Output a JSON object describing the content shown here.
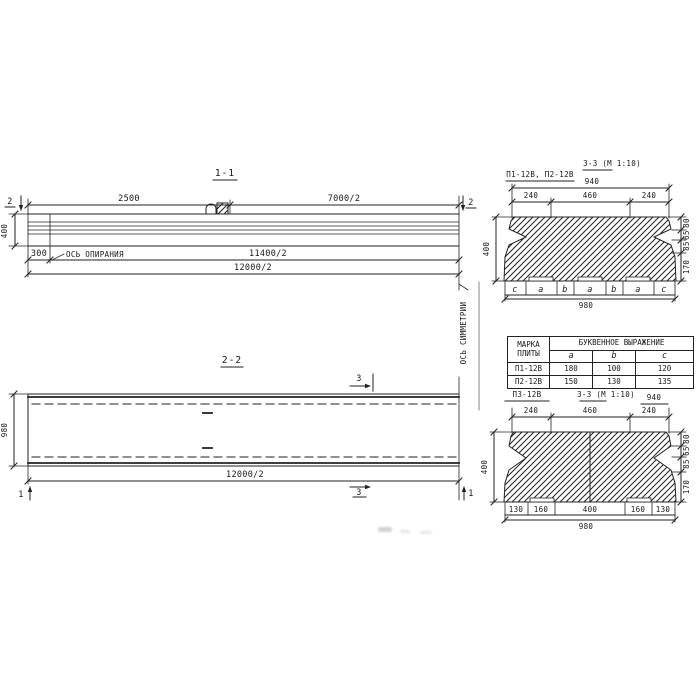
{
  "s11": {
    "title": "1-1",
    "d2500": "2500",
    "d7000": "7000/2",
    "m2": "2",
    "d400": "400",
    "d300": "300",
    "axis": "ОСЬ ОПИРАНИЯ",
    "d11400": "11400/2",
    "d12000": "12000/2"
  },
  "sym": {
    "label": "ОСЬ СИММЕТРИИ"
  },
  "s22": {
    "title": "2-2",
    "m3": "3",
    "m1": "1",
    "d980": "980",
    "d12000": "12000/2"
  },
  "p12": {
    "label": "П1-12В, П2-12В",
    "title": "3-3 (М 1:10)",
    "d940": "940",
    "d240": "240",
    "d460": "460",
    "d400": "400",
    "r0": "80",
    "r1": "65",
    "r2": "85",
    "r3": "170",
    "L0": "c",
    "L1": "a",
    "L2": "b",
    "d980": "980"
  },
  "table": {
    "header_mark": "МАРКА ПЛИТЫ",
    "header_expr": "БУКВЕННОЕ ВЫРАЖЕНИЕ",
    "cols": [
      "a",
      "b",
      "c"
    ],
    "rows": [
      {
        "mark": "П1-12В",
        "a": "180",
        "b": "100",
        "c": "120"
      },
      {
        "mark": "П2-12В",
        "a": "150",
        "b": "130",
        "c": "135"
      }
    ]
  },
  "p3": {
    "label": "П3-12В",
    "title": "3-3 (М 1:10)",
    "d940": "940",
    "d240": "240",
    "d460": "460",
    "d400": "400",
    "r0": "80",
    "r1": "65",
    "r2": "85",
    "r3": "170",
    "b130": "130",
    "b160": "160",
    "b400": "400",
    "d980": "980"
  }
}
